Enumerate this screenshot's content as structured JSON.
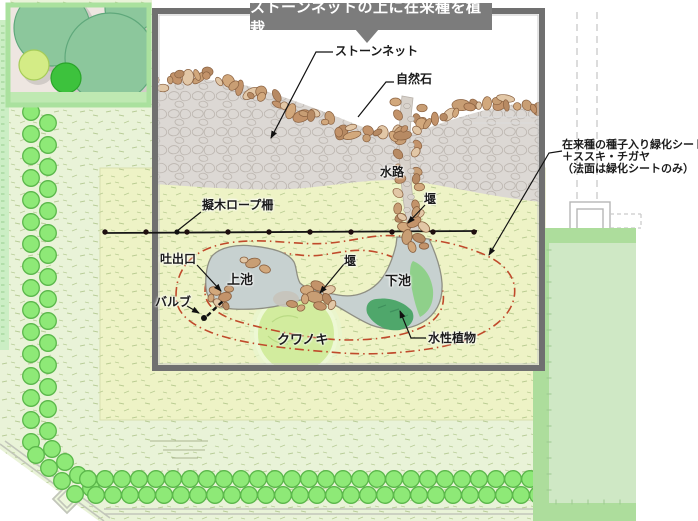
{
  "banner": {
    "text": "ストーンネットの上に在来種を植栽"
  },
  "annotations": {
    "stone_net": "ストーンネット",
    "natural_stone": "自然石",
    "waterway": "水路",
    "weir_top": "堰",
    "rope_fence": "擬木ロープ柵",
    "outlet": "吐出口",
    "upper_pond": "上池",
    "valve": "バルブ",
    "weir_mid": "堰",
    "lower_pond": "下池",
    "mulberry_tree": "クワノキ",
    "aquatic_plants": "水性植物",
    "seed_sheet_note_line1": "在来種の種子入り緑化シート",
    "seed_sheet_note_line2": "＋ススキ・チガヤ",
    "seed_sheet_note_line3": "（法面は緑化シートのみ）"
  },
  "colors": {
    "banner_bg": "#7c7c7c",
    "panel_border": "#707070",
    "ground_green": "#e9f3d8",
    "field_green": "#eef3c6",
    "stone_area_gray": "#dcd8d4",
    "stone_tan": "#c9996f",
    "water_gray": "#c7d1d0",
    "aquatic_dark_green": "#4fa76b",
    "aquatic_light_green": "#8fd08a",
    "tree_bright_green": "#8ee977",
    "tree_sage_green": "#8cc79c",
    "red_dashdot": "#c04a2b",
    "right_block_green": "#addd9c"
  }
}
